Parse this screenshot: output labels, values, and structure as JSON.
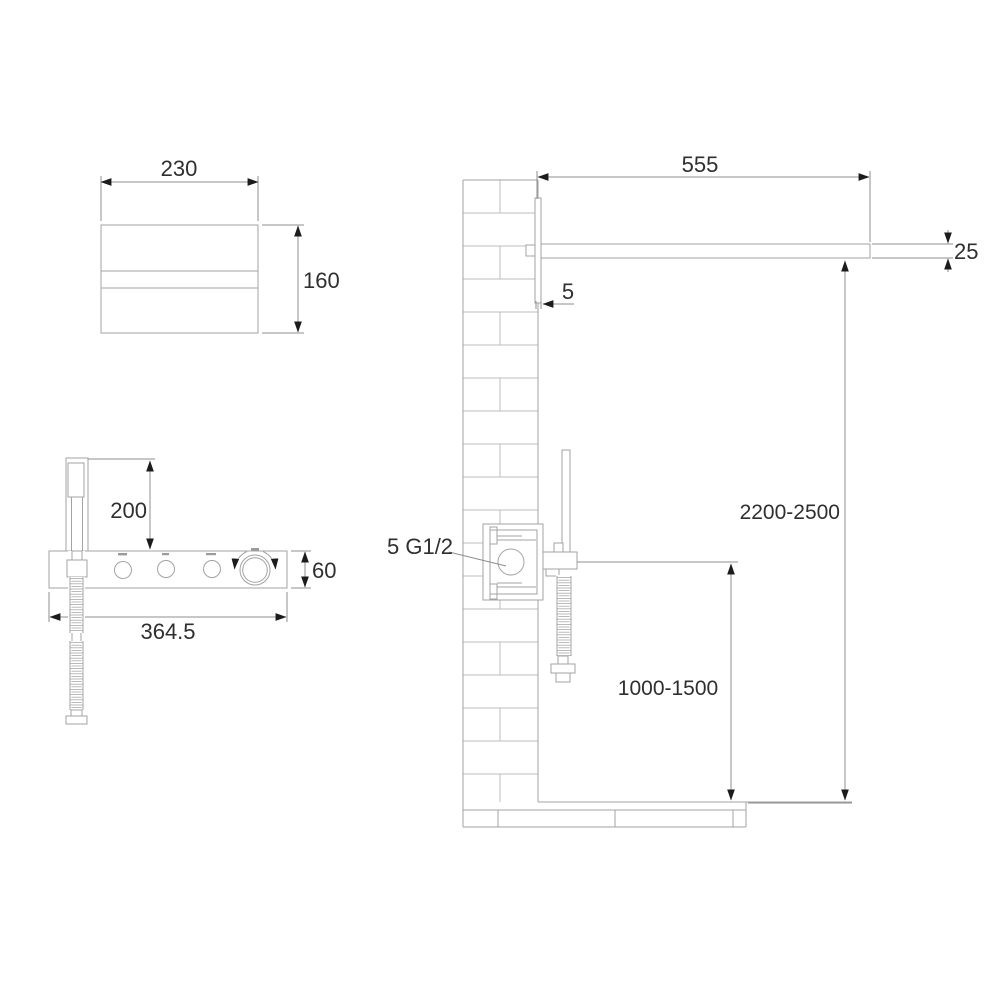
{
  "drawing": {
    "type": "shower-system-installation-dimension-drawing",
    "units_shown": "mm",
    "top_view": {
      "head_width": "230",
      "head_depth": "160"
    },
    "front_view": {
      "handshower_height": "200",
      "panel_height": "60",
      "panel_width": "364.5",
      "controls": [
        "button-1",
        "button-2",
        "button-3",
        "temperature-knob"
      ]
    },
    "side_view": {
      "arm_length": "555",
      "arm_thickness": "25",
      "plate_thickness": "5",
      "valve_connection": "5 G1/2",
      "head_height_range": "2200-2500",
      "handshower_height_range": "1000-1500"
    }
  }
}
